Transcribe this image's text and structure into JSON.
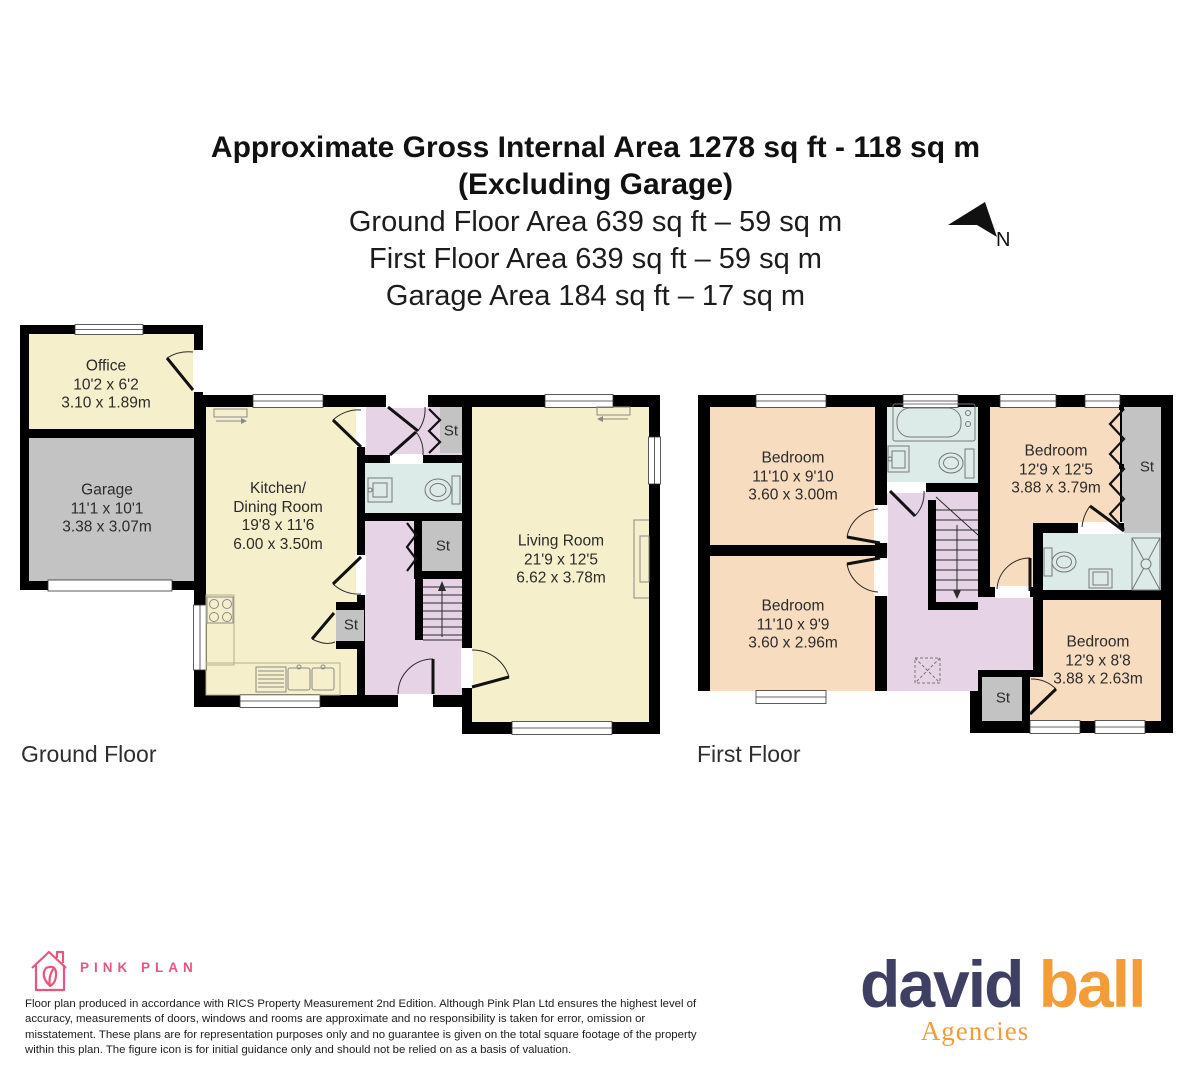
{
  "header": {
    "title_line1": "Approximate Gross Internal Area 1278 sq ft - 118 sq m",
    "title_line2": "(Excluding Garage)",
    "ground_area": "Ground Floor Area 639 sq ft – 59 sq m",
    "first_area": "First Floor Area 639 sq ft – 59 sq m",
    "garage_area": "Garage Area 184 sq ft – 17 sq m",
    "north_label": "N"
  },
  "labels": {
    "st": "St"
  },
  "floors": {
    "ground": {
      "label": "Ground Floor",
      "rooms": {
        "office": {
          "name": "Office",
          "imperial": "10'2 x 6'2",
          "metric": "3.10 x 1.89m"
        },
        "garage": {
          "name": "Garage",
          "imperial": "11'1 x 10'1",
          "metric": "3.38 x 3.07m"
        },
        "kitchen": {
          "name_line1": "Kitchen/",
          "name_line2": "Dining Room",
          "imperial": "19'8 x 11'6",
          "metric": "6.00 x 3.50m"
        },
        "living_room": {
          "name": "Living Room",
          "imperial": "21'9 x 12'5",
          "metric": "6.62 x 3.78m"
        }
      }
    },
    "first": {
      "label": "First Floor",
      "rooms": {
        "bedroom_front": {
          "name": "Bedroom",
          "imperial": "11'10 x 9'10",
          "metric": "3.60 x 3.00m"
        },
        "bedroom_right": {
          "name": "Bedroom",
          "imperial": "12'9 x 12'5",
          "metric": "3.88 x 3.79m"
        },
        "bedroom_back": {
          "name": "Bedroom",
          "imperial": "11'10 x 9'9",
          "metric": "3.60 x 2.96m"
        },
        "bedroom_small": {
          "name": "Bedroom",
          "imperial": "12'9 x 8'8",
          "metric": "3.88 x 2.63m"
        }
      }
    }
  },
  "footer": {
    "pink_plan_brand": "PINK PLAN",
    "disclaimer": "Floor plan produced in accordance with RICS Property Measurement 2nd Edition. Although Pink Plan Ltd ensures the highest level of accuracy, measurements of doors, windows and rooms are approximate and no responsibility is taken for error, omission or misstatement. These plans are for representation purposes only and no guarantee is given on the total square footage of the property within this plan. The figure icon is for initial guidance only and should not be relied on as a basis of valuation.",
    "agency_name_part1": "david",
    "agency_name_part2": "ball",
    "agency_subtitle": "Agencies"
  },
  "colors": {
    "room_cream": "#f6efcb",
    "room_gray": "#c3c3c3",
    "hall_lavender": "#e6d3e6",
    "bath_blue": "#dcebe7",
    "bedroom_peach": "#f8dcc0",
    "wall": "#000000",
    "pink_plan": "#e8557d",
    "agency_navy": "#3f3f63",
    "agency_orange": "#f39c38"
  }
}
